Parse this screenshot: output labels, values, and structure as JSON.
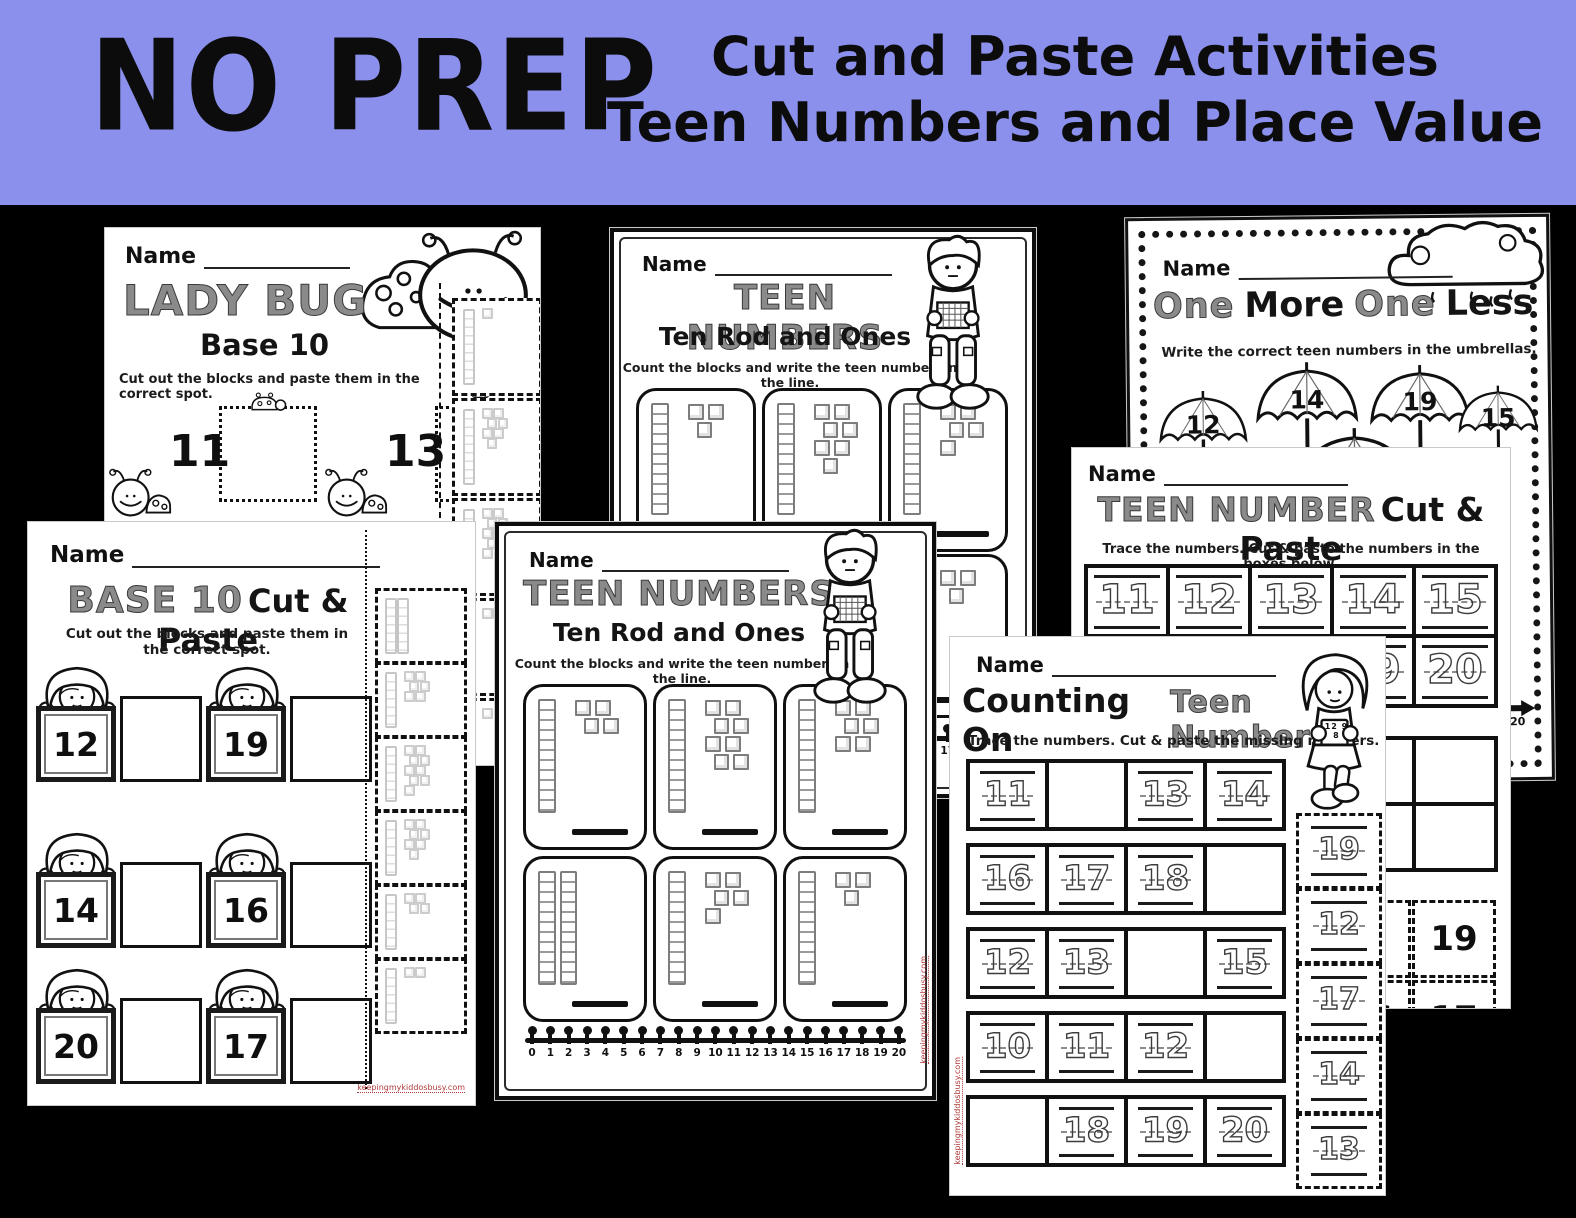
{
  "header": {
    "title": "NO PREP",
    "line1": "Cut and Paste Activities",
    "line2": "Teen Numbers and Place Value",
    "bg_color": "#8b90ec",
    "text_color": "#0c0c0c"
  },
  "watermark": "keepingmykiddosbusy.com",
  "number_line": [
    "0",
    "1",
    "2",
    "3",
    "4",
    "5",
    "6",
    "7",
    "8",
    "9",
    "10",
    "11",
    "12",
    "13",
    "14",
    "15",
    "16",
    "17",
    "18",
    "19",
    "20"
  ],
  "sheets": {
    "lady_bug": {
      "name_label": "Name",
      "title": "LADY BUG",
      "subtitle": "Base 10",
      "instructions": "Cut out the blocks and paste them in the correct spot.",
      "problems": [
        {
          "number": "11"
        },
        {
          "number": "13"
        }
      ],
      "cut_pieces": [
        {
          "rods": 1,
          "ones": 1
        },
        {
          "rods": 1,
          "ones": 7
        },
        {
          "rods": 1,
          "ones": 9
        },
        {
          "rods": 1,
          "ones": 2
        },
        {
          "rods": 1,
          "ones": 1
        }
      ]
    },
    "teen_top": {
      "name_label": "Name",
      "title": "TEEN NUMBERS",
      "subtitle": "Ten Rod and Ones",
      "instructions": "Count the blocks and write the teen number on the line.",
      "cards": [
        {
          "rods": 1,
          "ones": 3
        },
        {
          "rods": 1,
          "ones": 7
        },
        {
          "rods": 1,
          "ones": 5
        },
        {
          "rods": 2,
          "ones": 0
        },
        {
          "rods": 1,
          "ones": 5
        },
        {
          "rods": 1,
          "ones": 3
        }
      ]
    },
    "one_more": {
      "name_label": "Name",
      "title_parts": [
        "One",
        "More",
        "One",
        "Less"
      ],
      "instructions": "Write the correct teen numbers in the umbrellas.",
      "umbrellas": [
        "12",
        "14",
        "19",
        "15"
      ],
      "number_line_end": "20"
    },
    "cut_paste": {
      "name_label": "Name",
      "title_hatched": "TEEN NUMBER",
      "title_solid": "Cut & Paste",
      "instructions": "Trace the numbers.  Cut & paste the numbers in the boxes below.",
      "trace_rows": [
        [
          "11",
          "12",
          "13",
          "14",
          "15"
        ],
        [
          "16",
          "17",
          "18",
          "19",
          "20"
        ]
      ],
      "cut_cards": [
        [
          "",
          "19"
        ],
        [
          "16",
          "17"
        ]
      ]
    },
    "base10": {
      "name_label": "Name",
      "title_hatched": "BASE 10",
      "title_solid": "Cut & Paste",
      "instructions": "Cut out the blocks and paste them in the correct spot.",
      "kids": [
        {
          "number": "12"
        },
        {
          "number": "19"
        },
        {
          "number": "14"
        },
        {
          "number": "16"
        },
        {
          "number": "20"
        },
        {
          "number": "17"
        }
      ],
      "cut_pieces": [
        {
          "rods": 2,
          "ones": 0
        },
        {
          "rods": 1,
          "ones": 6
        },
        {
          "rods": 1,
          "ones": 9
        },
        {
          "rods": 1,
          "ones": 7
        },
        {
          "rods": 1,
          "ones": 4
        },
        {
          "rods": 1,
          "ones": 2
        }
      ]
    },
    "teen_center": {
      "name_label": "Name",
      "title": "TEEN NUMBERS",
      "subtitle": "Ten Rod and Ones",
      "instructions": "Count the blocks and write the teen number on the line.",
      "cards": [
        {
          "rods": 1,
          "ones": 4
        },
        {
          "rods": 1,
          "ones": 8
        },
        {
          "rods": 1,
          "ones": 6
        },
        {
          "rods": 2,
          "ones": 0
        },
        {
          "rods": 1,
          "ones": 5
        },
        {
          "rods": 1,
          "ones": 3
        }
      ]
    },
    "counting_on": {
      "name_label": "Name",
      "title_solid": "Counting On",
      "title_hatched": "Teen Numbers",
      "instructions": "Trace the numbers.  Cut & paste the missing numbers.",
      "grid": [
        [
          "11",
          "",
          "13",
          "14"
        ],
        [
          "16",
          "17",
          "18",
          ""
        ],
        [
          "12",
          "13",
          "",
          "15"
        ],
        [
          "10",
          "11",
          "12",
          ""
        ],
        [
          "",
          "18",
          "19",
          "20"
        ]
      ],
      "cut_strip": [
        "19",
        "12",
        "17",
        "14",
        "13"
      ],
      "tablet_numbers": "12 9 8"
    }
  }
}
